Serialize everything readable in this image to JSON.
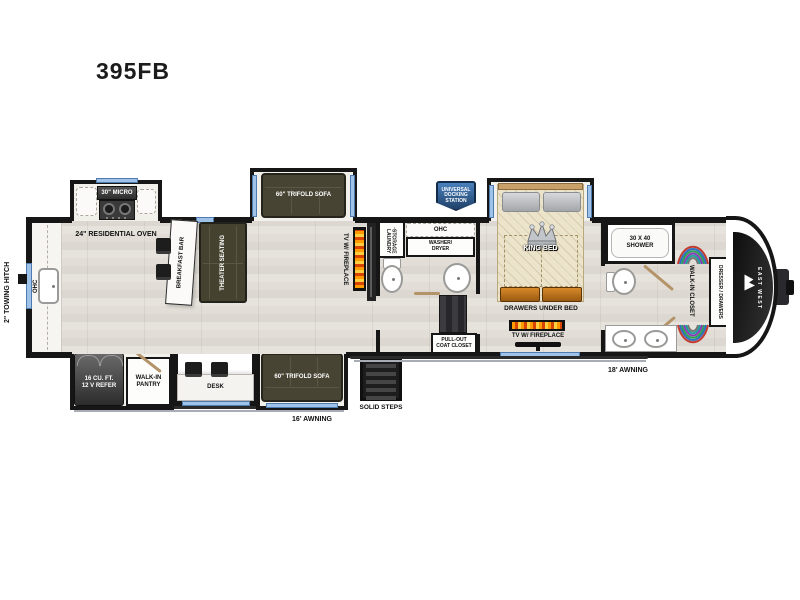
{
  "title": "395FB",
  "exterior": {
    "towing_hitch": "2\" TOWING HITCH",
    "docking_station": "UNIVERSAL\nDOCKING\nSTATION",
    "solid_steps": "SOLID STEPS",
    "awning_left": "16' AWNING",
    "awning_right": "18' AWNING",
    "brand": "EAST WEST"
  },
  "kitchen": {
    "ohc": "OHC",
    "micro": "30\" MICRO",
    "oven": "24\" RESIDENTIAL OVEN",
    "breakfast_bar": "BREAKFAST BAR",
    "refer": "16 CU. FT.\n12 V REFER",
    "pantry": "WALK-IN\nPANTRY",
    "desk": "DESK"
  },
  "living": {
    "theater": "THEATER SEATING",
    "sofa_top": "60\" TRIFOLD SOFA",
    "sofa_bottom": "60\" TRIFOLD SOFA",
    "tv_fireplace": "TV W/ FIREPLACE"
  },
  "mid_bath": {
    "laundry": "LAUNDRY\nSTORAGE",
    "ohc": "OHC",
    "washer_dryer": "WASHER/\nDRYER",
    "coat_closet": "PULL-OUT\nCOAT CLOSET"
  },
  "bedroom": {
    "king_bed": "KING BED",
    "drawers_under_bed": "DRAWERS UNDER BED",
    "tv_fireplace": "TV W/ FIREPLACE"
  },
  "rear_bath": {
    "shower": "30 X 40\nSHOWER",
    "closet": "WALK-IN CLOSET",
    "dresser": "DRESSER / DRAWERS"
  },
  "colors": {
    "wall": "#161616",
    "window_blue": "#9fc2e8",
    "sofa_olive": "#474434",
    "bed_tan": "#ece3cb",
    "drawer_orange": "#c07820",
    "badge_blue": "#2e5b94",
    "flame_orange": "#e85d00"
  }
}
